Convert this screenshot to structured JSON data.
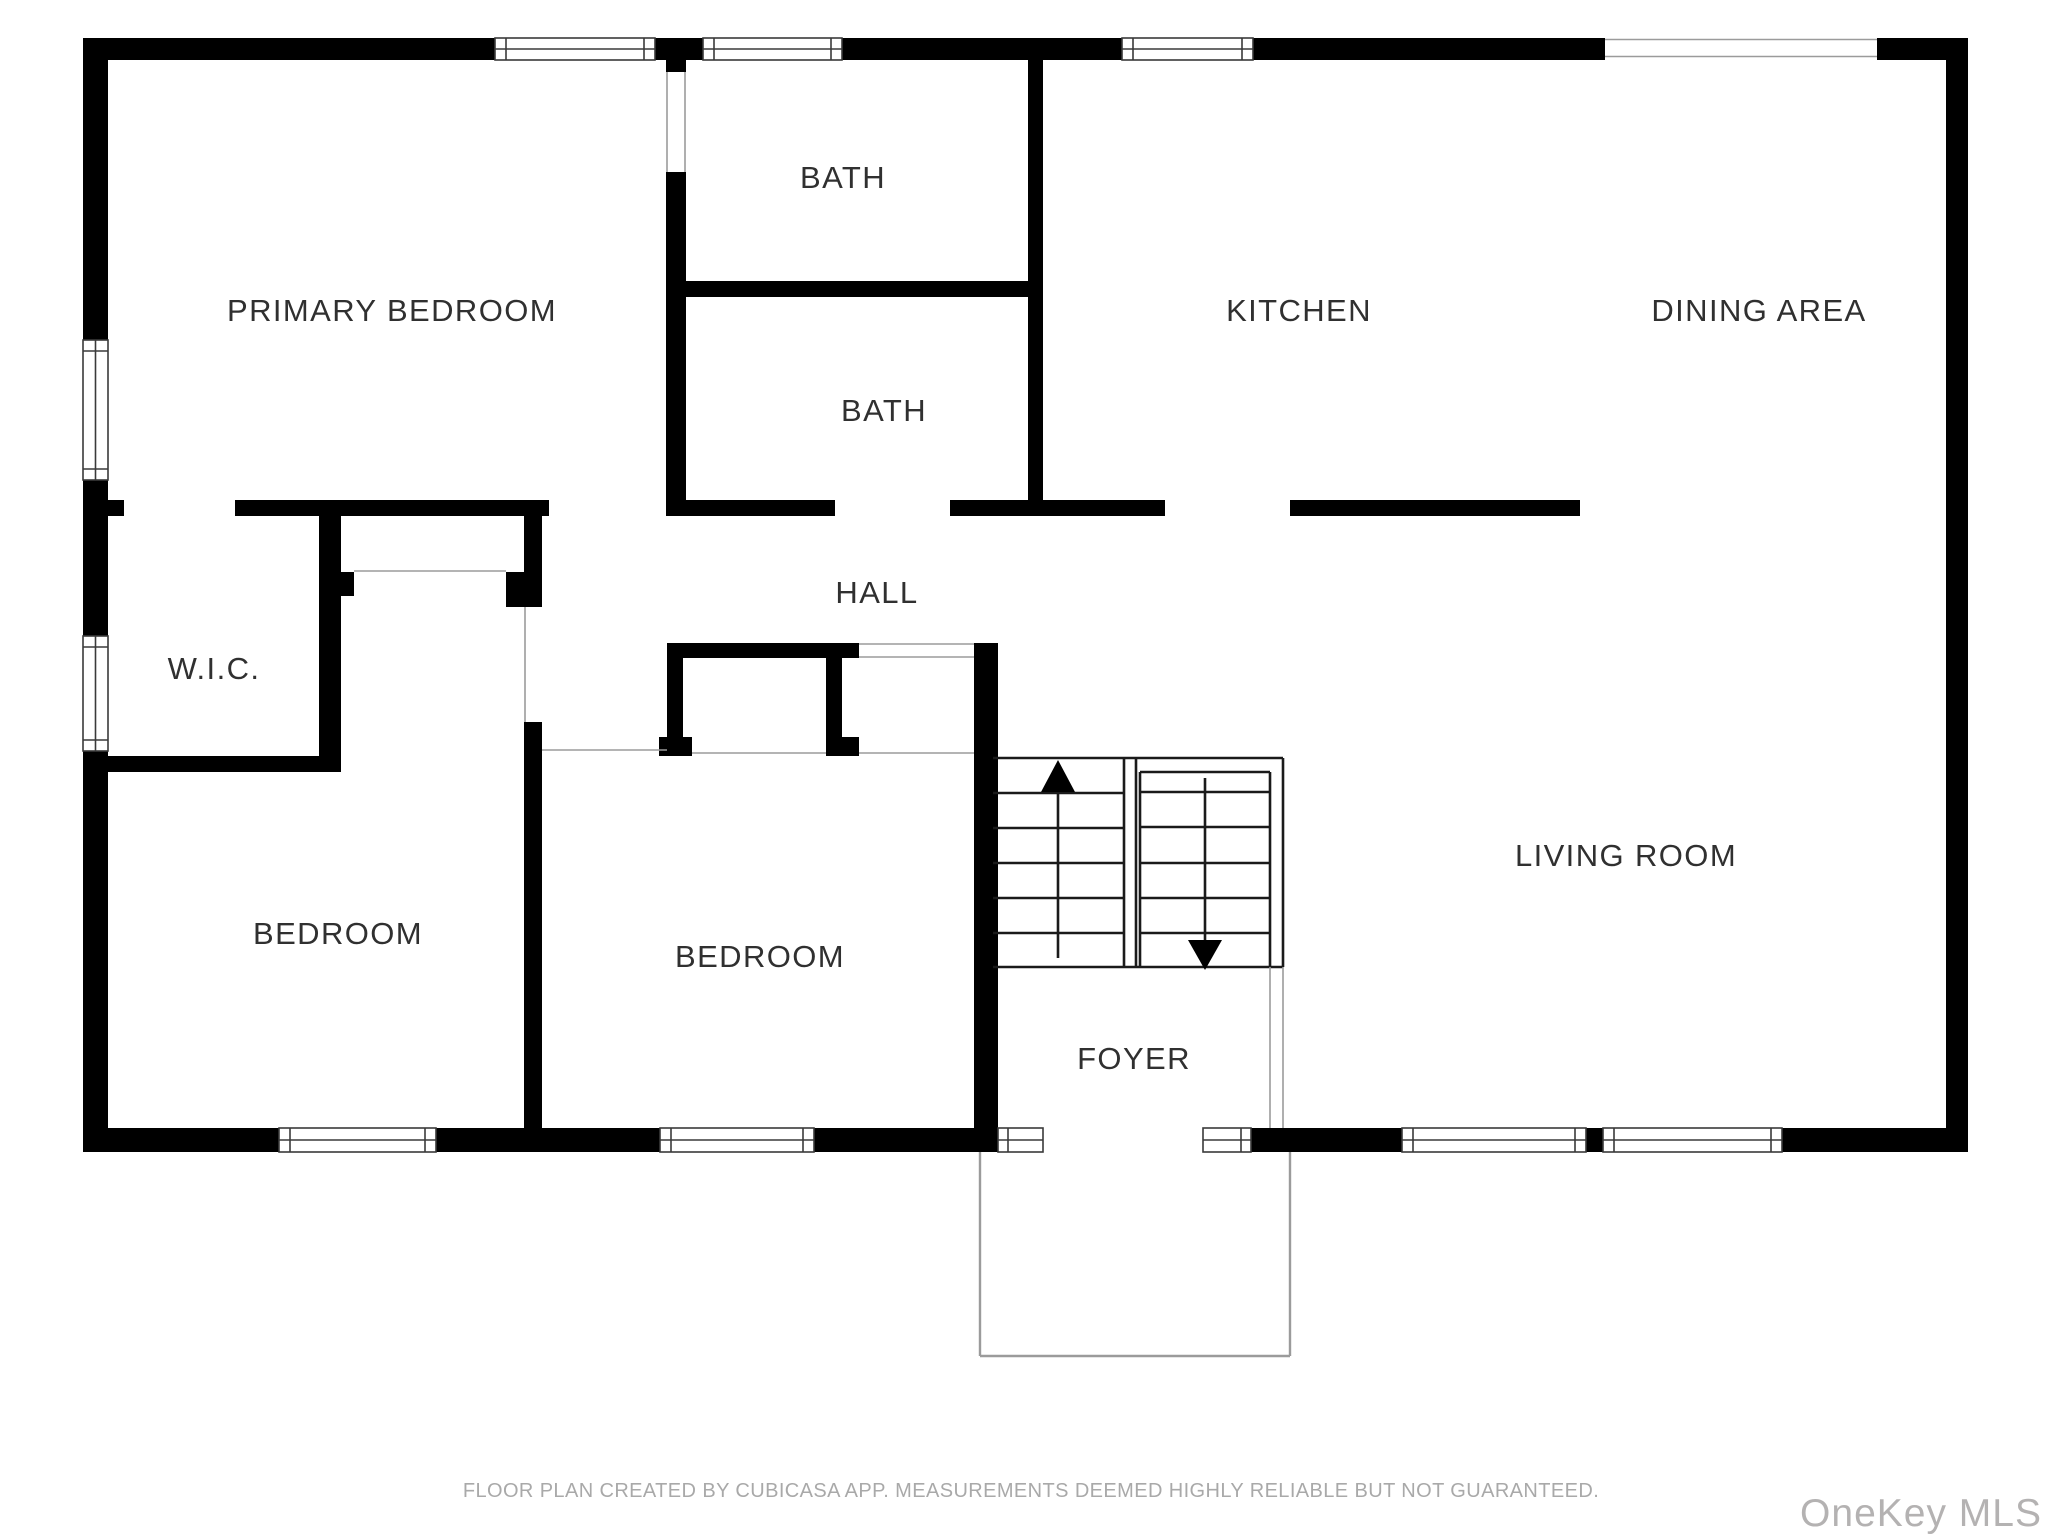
{
  "floor_plan": {
    "rooms": {
      "primary_bedroom": {
        "label": "PRIMARY BEDROOM"
      },
      "bath_top": {
        "label": "BATH"
      },
      "bath_bottom": {
        "label": "BATH"
      },
      "kitchen": {
        "label": "KITCHEN"
      },
      "dining_area": {
        "label": "DINING AREA"
      },
      "hall": {
        "label": "HALL"
      },
      "wic": {
        "label": "W.I.C."
      },
      "bedroom_left": {
        "label": "BEDROOM"
      },
      "bedroom_middle": {
        "label": "BEDROOM"
      },
      "foyer": {
        "label": "FOYER"
      },
      "living_room": {
        "label": "LIVING ROOM"
      }
    },
    "stairs": {
      "up_arrow_direction": "up",
      "down_arrow_direction": "down"
    },
    "colors": {
      "wall": "#000000",
      "room_label": "#303030",
      "window_outline": "#3a3a3a",
      "light_line": "#9b9b9b",
      "footer_text": "#a9a9a9",
      "watermark_text": "#b4b2b2",
      "background": "#ffffff"
    }
  },
  "footer": {
    "disclaimer": "FLOOR PLAN CREATED BY CUBICASA APP. MEASUREMENTS DEEMED HIGHLY RELIABLE BUT NOT GUARANTEED."
  },
  "watermark": {
    "text": "OneKey MLS"
  }
}
